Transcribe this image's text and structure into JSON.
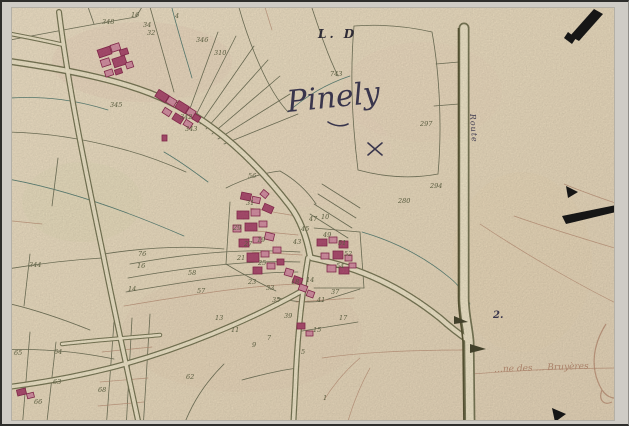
{
  "map": {
    "labels": {
      "section": "L. D",
      "title": "Pinely",
      "route": "Route",
      "junction": "2.",
      "margin_note": "…ne des … Bruyères",
      "under_title_number": "743"
    },
    "colors": {
      "paper": "#eee0c2",
      "line": "#73745a",
      "teal": "#5d8276",
      "faint": "#bc8f74",
      "roadFill": "#f1e7ca",
      "roadEdge": "#7c7a58",
      "routeEdge": "#5c5836",
      "bldFill": "#d893a6",
      "bldDark": "#b04f72",
      "bldStroke": "#8e2d52",
      "num": "#646747",
      "ink": "#403c55",
      "mark": "#191919"
    }
  },
  "parcel_numbers": [
    {
      "n": "348",
      "x": 100,
      "y": 22
    },
    {
      "n": "16",
      "x": 129,
      "y": 15
    },
    {
      "n": "34",
      "x": 141,
      "y": 25
    },
    {
      "n": "32",
      "x": 145,
      "y": 33
    },
    {
      "n": "4",
      "x": 173,
      "y": 16
    },
    {
      "n": "346",
      "x": 194,
      "y": 40
    },
    {
      "n": "310",
      "x": 212,
      "y": 53
    },
    {
      "n": "345",
      "x": 108,
      "y": 105
    },
    {
      "n": "342",
      "x": 178,
      "y": 117
    },
    {
      "n": "343",
      "x": 183,
      "y": 129
    },
    {
      "n": "297",
      "x": 418,
      "y": 124
    },
    {
      "n": "294",
      "x": 428,
      "y": 186
    },
    {
      "n": "280",
      "x": 396,
      "y": 201
    },
    {
      "n": "56",
      "x": 246,
      "y": 176
    },
    {
      "n": "31",
      "x": 244,
      "y": 203
    },
    {
      "n": "29",
      "x": 231,
      "y": 228
    },
    {
      "n": "27",
      "x": 242,
      "y": 244
    },
    {
      "n": "19",
      "x": 255,
      "y": 240
    },
    {
      "n": "25",
      "x": 256,
      "y": 263
    },
    {
      "n": "21",
      "x": 235,
      "y": 258
    },
    {
      "n": "23",
      "x": 246,
      "y": 282
    },
    {
      "n": "43",
      "x": 291,
      "y": 242
    },
    {
      "n": "45",
      "x": 299,
      "y": 229
    },
    {
      "n": "47",
      "x": 307,
      "y": 219
    },
    {
      "n": "49",
      "x": 321,
      "y": 235
    },
    {
      "n": "51",
      "x": 336,
      "y": 243
    },
    {
      "n": "52",
      "x": 342,
      "y": 254
    },
    {
      "n": "54",
      "x": 334,
      "y": 266
    },
    {
      "n": "10",
      "x": 319,
      "y": 217
    },
    {
      "n": "33",
      "x": 264,
      "y": 288
    },
    {
      "n": "18",
      "x": 289,
      "y": 282
    },
    {
      "n": "14",
      "x": 304,
      "y": 280
    },
    {
      "n": "35",
      "x": 270,
      "y": 300
    },
    {
      "n": "39",
      "x": 282,
      "y": 316
    },
    {
      "n": "41",
      "x": 315,
      "y": 300
    },
    {
      "n": "37",
      "x": 329,
      "y": 292
    },
    {
      "n": "15",
      "x": 311,
      "y": 330
    },
    {
      "n": "17",
      "x": 337,
      "y": 318
    },
    {
      "n": "76",
      "x": 136,
      "y": 254
    },
    {
      "n": "16",
      "x": 135,
      "y": 266
    },
    {
      "n": "14",
      "x": 126,
      "y": 289
    },
    {
      "n": "58",
      "x": 186,
      "y": 273
    },
    {
      "n": "57",
      "x": 195,
      "y": 291
    },
    {
      "n": "344",
      "x": 27,
      "y": 265
    },
    {
      "n": "64",
      "x": 52,
      "y": 352
    },
    {
      "n": "63",
      "x": 51,
      "y": 382
    },
    {
      "n": "65",
      "x": 12,
      "y": 353
    },
    {
      "n": "66",
      "x": 32,
      "y": 402
    },
    {
      "n": "62",
      "x": 184,
      "y": 377
    },
    {
      "n": "68",
      "x": 96,
      "y": 390
    },
    {
      "n": "9",
      "x": 250,
      "y": 345
    },
    {
      "n": "11",
      "x": 229,
      "y": 330
    },
    {
      "n": "13",
      "x": 213,
      "y": 318
    },
    {
      "n": "7",
      "x": 265,
      "y": 338
    },
    {
      "n": "5",
      "x": 299,
      "y": 352
    },
    {
      "n": "1",
      "x": 321,
      "y": 398
    }
  ],
  "buildings_format": "x,y,w,h,angle,dark",
  "buildings": [
    [
      96,
      46,
      13,
      8,
      -18,
      1
    ],
    [
      109,
      42,
      9,
      7,
      -18,
      0
    ],
    [
      118,
      47,
      8,
      6,
      -18,
      1
    ],
    [
      99,
      57,
      9,
      7,
      -18,
      0
    ],
    [
      111,
      55,
      13,
      9,
      -18,
      1
    ],
    [
      124,
      60,
      7,
      6,
      -18,
      0
    ],
    [
      103,
      68,
      8,
      6,
      -18,
      0
    ],
    [
      113,
      67,
      7,
      5,
      -18,
      1
    ],
    [
      154,
      90,
      12,
      8,
      32,
      1
    ],
    [
      165,
      96,
      9,
      7,
      32,
      0
    ],
    [
      174,
      101,
      12,
      8,
      32,
      1
    ],
    [
      185,
      107,
      8,
      7,
      32,
      0
    ],
    [
      161,
      107,
      8,
      6,
      32,
      0
    ],
    [
      171,
      113,
      10,
      7,
      32,
      1
    ],
    [
      182,
      119,
      8,
      6,
      32,
      0
    ],
    [
      191,
      113,
      7,
      6,
      32,
      1
    ],
    [
      160,
      133,
      5,
      6,
      0,
      1
    ],
    [
      239,
      191,
      10,
      7,
      12,
      1
    ],
    [
      250,
      195,
      8,
      6,
      12,
      0
    ],
    [
      259,
      189,
      7,
      6,
      40,
      0
    ],
    [
      235,
      209,
      12,
      8,
      0,
      1
    ],
    [
      249,
      207,
      9,
      7,
      0,
      0
    ],
    [
      261,
      203,
      10,
      7,
      24,
      1
    ],
    [
      231,
      223,
      8,
      7,
      0,
      0
    ],
    [
      243,
      221,
      12,
      8,
      0,
      1
    ],
    [
      257,
      219,
      8,
      6,
      0,
      0
    ],
    [
      237,
      237,
      10,
      8,
      0,
      1
    ],
    [
      251,
      235,
      8,
      6,
      0,
      0
    ],
    [
      263,
      231,
      9,
      7,
      14,
      0
    ],
    [
      245,
      251,
      12,
      9,
      0,
      1
    ],
    [
      259,
      249,
      8,
      6,
      0,
      0
    ],
    [
      251,
      265,
      9,
      7,
      0,
      1
    ],
    [
      265,
      261,
      8,
      6,
      0,
      0
    ],
    [
      271,
      245,
      8,
      6,
      0,
      0
    ],
    [
      275,
      257,
      7,
      6,
      0,
      1
    ],
    [
      283,
      267,
      8,
      7,
      16,
      0
    ],
    [
      291,
      275,
      9,
      7,
      20,
      1
    ],
    [
      297,
      283,
      8,
      6,
      20,
      0
    ],
    [
      305,
      289,
      7,
      6,
      20,
      0
    ],
    [
      315,
      237,
      10,
      7,
      0,
      1
    ],
    [
      327,
      235,
      8,
      6,
      0,
      0
    ],
    [
      337,
      239,
      9,
      7,
      0,
      1
    ],
    [
      319,
      251,
      8,
      6,
      0,
      0
    ],
    [
      331,
      249,
      10,
      8,
      0,
      1
    ],
    [
      343,
      253,
      7,
      6,
      0,
      0
    ],
    [
      325,
      263,
      9,
      7,
      0,
      0
    ],
    [
      337,
      265,
      10,
      7,
      0,
      1
    ],
    [
      347,
      261,
      7,
      5,
      0,
      0
    ],
    [
      295,
      321,
      8,
      6,
      0,
      1
    ],
    [
      304,
      329,
      7,
      5,
      0,
      0
    ],
    [
      15,
      387,
      9,
      6,
      -14,
      1
    ],
    [
      25,
      391,
      7,
      5,
      -14,
      0
    ]
  ]
}
